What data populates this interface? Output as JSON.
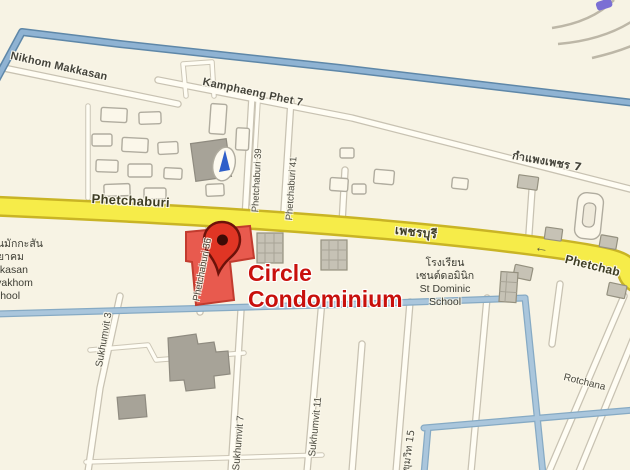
{
  "map": {
    "poi": {
      "line1": "Circle",
      "line2": "Condominium"
    },
    "roads": {
      "nikhom_makkasan": "Nikhom Makkasan",
      "kamphaeng_phet_7": "Kamphaeng Phet 7",
      "kamphaeng_phet_7_thai": "กำแพงเพชร 7",
      "phetchaburi": "Phetchaburi",
      "phetchaburi_thai": "เพชรบุรี",
      "phetchaburi_partial": "Phetchab",
      "phetchaburi_36": "Phetchaburi 36",
      "phetchaburi_39": "Phetchaburi 39",
      "phetchaburi_41": "Phetchaburi 41",
      "sukhumvit_3": "Sukhumvit 3",
      "sukhumvit_7": "Sukhumvit 7",
      "sukhumvit_11": "Sukhumvit 11",
      "sukhumvit_15_thai": "สุขุมวิท 15",
      "rotchana_partial": "Rotchana"
    },
    "places": {
      "makkasan_school": {
        "thai1": "โรงเรียนมักกะสัน",
        "thai2": "พิทยาคม",
        "en1": "Makkasan",
        "en2": "Pittayakhom",
        "en3": "School"
      },
      "st_dominic_school": {
        "thai1": "โรงเรียน",
        "thai2": "เซนต์ดอมินิก",
        "en1": "St Dominic",
        "en2": "School"
      }
    },
    "icons": {
      "one_way_arrow": "←"
    },
    "colors": {
      "highway_yellow": "#f6ec49",
      "blue_road": "#8fb3d3",
      "poi_text": "#c8100c",
      "poi_building": "#e85a4e",
      "pin_red": "#e03524"
    }
  }
}
